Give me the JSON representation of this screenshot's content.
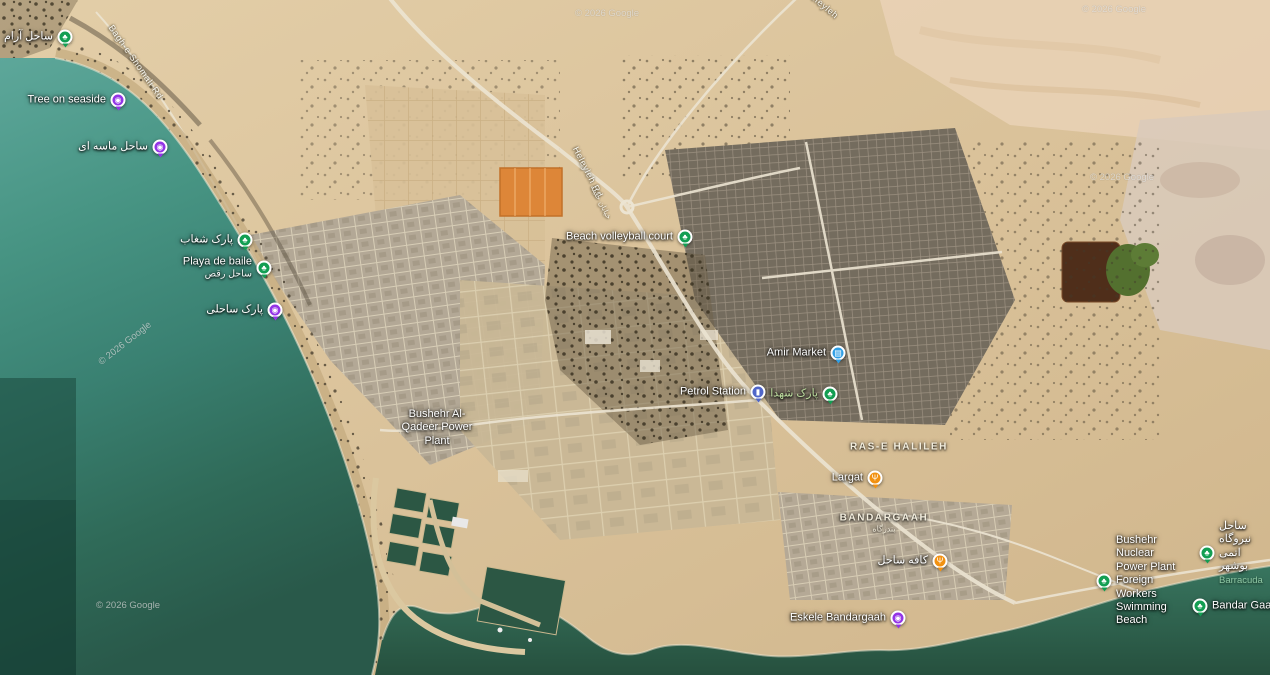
{
  "map": {
    "attribution": "© 2026 Google",
    "colors": {
      "green": "#129e52",
      "purple": "#9334e6",
      "blue": "#2e9fe6",
      "indigo": "#5066c9",
      "orange": "#f29111",
      "label": "#ffffff",
      "park_label": "#bcdc9e",
      "area_label": "#f3eede"
    },
    "pins": [
      {
        "name": "calm-beach",
        "label": "ساحل آرام",
        "x": 65,
        "y": 37,
        "color": "green",
        "icon": "park-icon",
        "side": "left"
      },
      {
        "name": "tree-on-seaside",
        "label": "Tree on seaside",
        "x": 118,
        "y": 100,
        "color": "purple",
        "icon": "camera-icon",
        "side": "left"
      },
      {
        "name": "sandy-beach",
        "label": "ساحل ماسه ای",
        "x": 160,
        "y": 147,
        "color": "purple",
        "icon": "camera-icon",
        "side": "left"
      },
      {
        "name": "shoghab-park",
        "label": "پارک شغاب",
        "x": 245,
        "y": 240,
        "color": "green",
        "icon": "park-icon",
        "side": "left"
      },
      {
        "name": "playa-de-baile",
        "label": "Playa de baile",
        "sub_label": "ساحل رقص",
        "x": 264,
        "y": 268,
        "color": "green",
        "icon": "park-icon",
        "side": "left"
      },
      {
        "name": "coastal-park",
        "label": "پارک ساحلی",
        "x": 275,
        "y": 310,
        "color": "purple",
        "icon": "camera-icon",
        "side": "left"
      },
      {
        "name": "beach-volleyball-court",
        "label": "Beach volleyball court",
        "x": 685,
        "y": 237,
        "color": "green",
        "icon": "park-icon",
        "side": "left"
      },
      {
        "name": "amir-market",
        "label": "Amir Market",
        "x": 838,
        "y": 353,
        "color": "blue",
        "icon": "cart-icon",
        "side": "left"
      },
      {
        "name": "petrol-station",
        "label": "Petrol Station",
        "x": 758,
        "y": 392,
        "color": "indigo",
        "icon": "fuel-icon",
        "side": "left"
      },
      {
        "name": "shohada-park",
        "label": "پارک شهدا",
        "x": 830,
        "y": 394,
        "color": "green",
        "icon": "park-icon",
        "side": "left",
        "label_style": "park-text"
      },
      {
        "name": "power-plant",
        "label": "Bushehr Al-Qadeer Power Plant",
        "x": 437,
        "y": 428,
        "color": null,
        "side": "center",
        "width": 80
      },
      {
        "name": "largat-restaurant",
        "label": "Largat",
        "x": 875,
        "y": 478,
        "color": "orange",
        "icon": "restaurant-icon",
        "side": "left"
      },
      {
        "name": "beach-cafe",
        "label": "کافه ساحل",
        "x": 940,
        "y": 561,
        "color": "orange",
        "icon": "restaurant-icon",
        "side": "left"
      },
      {
        "name": "eskele-bandargaah",
        "label": "Eskele Bandargaah",
        "x": 898,
        "y": 618,
        "color": "purple",
        "icon": "camera-icon",
        "side": "left"
      },
      {
        "name": "nuclear-workers-beach",
        "label": "Bushehr Nuclear Power Plant Foreign Workers Swimming Beach",
        "x": 1104,
        "y": 581,
        "color": "green",
        "icon": "park-icon",
        "side": "right",
        "width": 64
      },
      {
        "name": "atomic-plant-beach",
        "label": "ساحل نیروگاه اتمی بوشهر",
        "sub_label": "Barracuda",
        "sub_style": "dark-green",
        "x": 1207,
        "y": 553,
        "color": "green",
        "icon": "park-icon",
        "side": "right",
        "width": 46
      },
      {
        "name": "bandar-gaah",
        "label": "Bandar Gaah",
        "x": 1200,
        "y": 606,
        "color": "green",
        "icon": "park-icon",
        "side": "right"
      }
    ],
    "area_labels": [
      {
        "name": "ras-e-halileh",
        "text": "RAS-E HALILEH",
        "x": 899,
        "y": 447
      },
      {
        "name": "bandargaah-district",
        "text": "BANDARGAAH",
        "sub": "بندرگاه",
        "x": 884,
        "y": 523
      }
    ],
    "road_labels": [
      {
        "name": "heleyleh-rd",
        "text": "Heleyleh Rd",
        "x": 588,
        "y": 172,
        "rot": 63
      },
      {
        "name": "bagh-e-shomali-rd",
        "text": "Bagh-e Shomali Rd",
        "x": 136,
        "y": 62,
        "rot": 55
      },
      {
        "name": "heleyleh-rd-top",
        "text": "Heleyleh",
        "x": 822,
        "y": 4,
        "rot": 40
      },
      {
        "name": "halileh-street-fa",
        "text": "خیابان حلیله",
        "x": 601,
        "y": 202,
        "rot": 63,
        "small": true
      }
    ],
    "watermarks": [
      {
        "x": 575,
        "y": 8,
        "rot": 0
      },
      {
        "x": 1082,
        "y": 4,
        "rot": 0
      },
      {
        "x": 1090,
        "y": 172,
        "rot": 0
      },
      {
        "x": 93,
        "y": 338,
        "rot": -38
      },
      {
        "x": 96,
        "y": 600,
        "rot": 0
      }
    ]
  }
}
